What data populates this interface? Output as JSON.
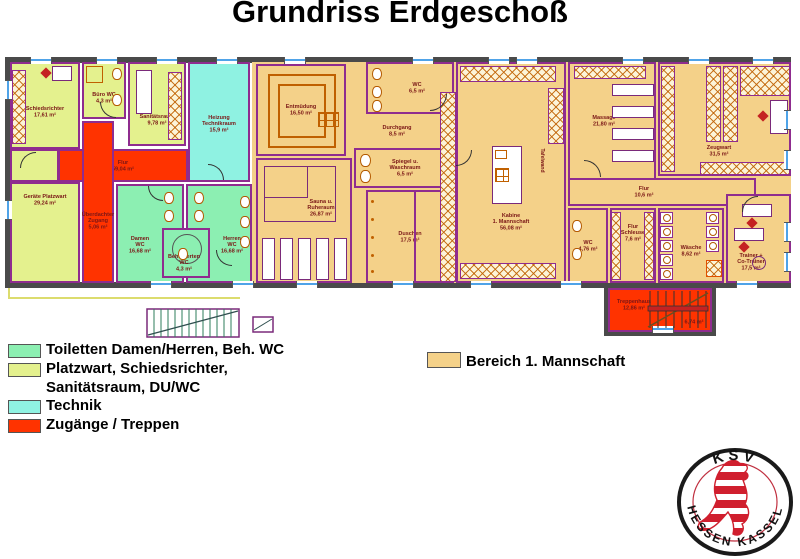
{
  "title": "Grundriss Erdgeschoß",
  "legend": {
    "items": [
      {
        "label": "Toiletten Damen/Herren, Beh. WC",
        "color": "#8CEFB2"
      },
      {
        "label": "Platzwart, Schiedsrichter,\nSanitätsraum, DU/WC",
        "color": "#E4F18E"
      },
      {
        "label": "Technik",
        "color": "#8FF2E2"
      },
      {
        "label": "Zugänge / Treppen",
        "color": "#FF3300"
      }
    ]
  },
  "area_legend": {
    "label": "Bereich 1. Mannschaft",
    "color": "#F4D189"
  },
  "logo": {
    "top": "KSV",
    "bottom": "HESSEN  KASSEL",
    "lion_color": "#D01F2E"
  },
  "rooms": {
    "schiedsrichter": {
      "label": "Schiedsrichter\n17,61 m²"
    },
    "buero_wc": {
      "label": "Büro WC\n4,3 m²"
    },
    "sanitaetsraum": {
      "label": "Sanitätsraum\n9,78 m²"
    },
    "heizung": {
      "label": "Heizung\nTechnikraum\n15,9 m²"
    },
    "geraete": {
      "label": "Geräte Platzwart\n29,24 m²"
    },
    "flur": {
      "label": "Flur\n59,04 m²"
    },
    "zugang": {
      "label": "Überdachter\nZugang\n5,06 m²"
    },
    "damen_wc": {
      "label": "Damen\nWC\n16,68 m²"
    },
    "herren_wc": {
      "label": "Herren\nWC\n16,68 m²"
    },
    "beh_wc": {
      "label": "Behinderten\nWC\n4,3 m²"
    },
    "entmuedung": {
      "label": "Entmüdung\n16,50 m²"
    },
    "sauna": {
      "label": "Sauna u.\nRuheraum\n26,87 m²"
    },
    "wc_team": {
      "label": "WC\n6,5 m²"
    },
    "durchgang": {
      "label": "Durchgang\n8,5 m²"
    },
    "spiegel": {
      "label": "Spiegel u.\nWaschraum\n6,5 m²"
    },
    "duschen": {
      "label": "Duschen\n17,5 m²"
    },
    "kabine": {
      "label": "Kabine\n1. Mannschaft\n56,08 m²",
      "wall_note": "Tafelwand"
    },
    "massage": {
      "label": "Massage\n21,80 m²"
    },
    "zeugwart": {
      "label": "Zeugwart\n31,5 m²"
    },
    "flur_rechts": {
      "label": "Flur\n10,6 m²"
    },
    "wc_rechts": {
      "label": "WC\n4,76 m²"
    },
    "schleuse": {
      "label": "Flur\nSchleuse\n7,6 m²"
    },
    "waesche": {
      "label": "Wäsche\n8,62 m²"
    },
    "trainer": {
      "label": "Trainer +\nCo-Trainer\n17,5 m²"
    },
    "treppenhaus": {
      "label": "Treppenhaus\n12,86 m²",
      "note": "6,74 m²"
    }
  }
}
